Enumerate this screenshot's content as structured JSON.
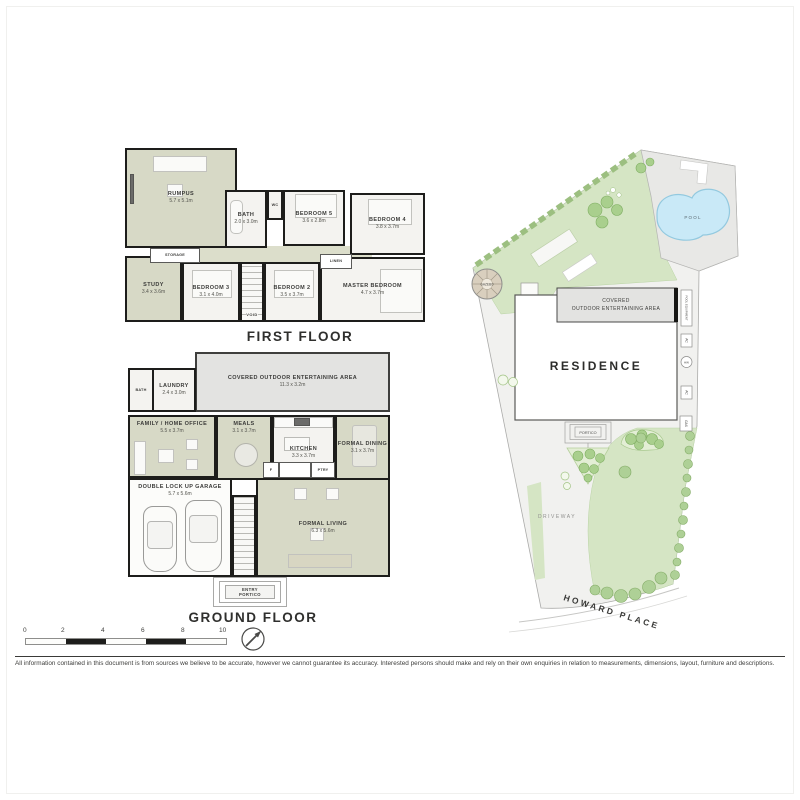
{
  "captions": {
    "first_floor": "FIRST FLOOR",
    "ground_floor": "GROUND FLOOR"
  },
  "first_floor": {
    "rooms": [
      {
        "name": "RUMPUS",
        "dims": "5.7 x 5.1m"
      },
      {
        "name": "BATH",
        "dims": "2.0 x 3.0m"
      },
      {
        "name": "WC",
        "dims": ""
      },
      {
        "name": "BEDROOM 5",
        "dims": "3.6 x 2.8m"
      },
      {
        "name": "BEDROOM 4",
        "dims": "3.8 x 3.7m"
      },
      {
        "name": "STORAGE",
        "dims": ""
      },
      {
        "name": "STUDY",
        "dims": "3.4 x 3.6m"
      },
      {
        "name": "BEDROOM 3",
        "dims": "3.1 x 4.0m"
      },
      {
        "name": "VOID",
        "dims": ""
      },
      {
        "name": "BEDROOM 2",
        "dims": "3.5 x 3.7m"
      },
      {
        "name": "LINEN",
        "dims": ""
      },
      {
        "name": "MASTER BEDROOM",
        "dims": "4.7 x 3.7m"
      }
    ]
  },
  "ground_floor": {
    "rooms": [
      {
        "name": "COVERED OUTDOOR ENTERTAINING AREA",
        "dims": "11.3 x 3.2m"
      },
      {
        "name": "BATH",
        "dims": ""
      },
      {
        "name": "LAUNDRY",
        "dims": "2.4 x 3.0m"
      },
      {
        "name": "FAMILY / HOME OFFICE",
        "dims": "5.5 x 3.7m"
      },
      {
        "name": "MEALS",
        "dims": "3.1 x 3.7m"
      },
      {
        "name": "KITCHEN",
        "dims": "3.3 x 3.7m"
      },
      {
        "name": "FORMAL DINING",
        "dims": "3.1 x 3.7m"
      },
      {
        "name": "DOUBLE LOCK UP GARAGE",
        "dims": "5.7 x 5.6m"
      },
      {
        "name": "FORMAL LIVING",
        "dims": "6.3 x 5.6m"
      },
      {
        "name": "F",
        "dims": ""
      },
      {
        "name": "PTRY",
        "dims": ""
      },
      {
        "name": "ENTRY",
        "dims": ""
      },
      {
        "name": "PORTICO",
        "dims": ""
      }
    ]
  },
  "site_plan": {
    "labels": {
      "pool": "POOL",
      "gazebo": "GAZEBO",
      "coea_line1": "COVERED",
      "coea_line2": "OUTDOOR ENTERTAINING AREA",
      "residence": "RESIDENCE",
      "portico": "PORTICO",
      "driveway": "DRIVEWAY",
      "street": "HOWARD PLACE",
      "utilities": [
        "POOL EQUIPMENT",
        "AC",
        "HW",
        "AC",
        "GAS"
      ]
    }
  },
  "scale_bar": {
    "ticks": [
      "0",
      "2",
      "4",
      "6",
      "8",
      "10"
    ]
  },
  "disclaimer": "All information contained in this document is from sources we believe to be accurate, however we cannot guarantee its accuracy. Interested persons should make and rely on their own enquiries in relation to measurements, dimensions, layout, furniture and descriptions.",
  "colors": {
    "wall": "#1d1d1b",
    "room_green": "#d7d9c6",
    "paving": "#e6e6e4",
    "lawn": "#d5e5c4",
    "pool_water": "#c9e9f7"
  }
}
